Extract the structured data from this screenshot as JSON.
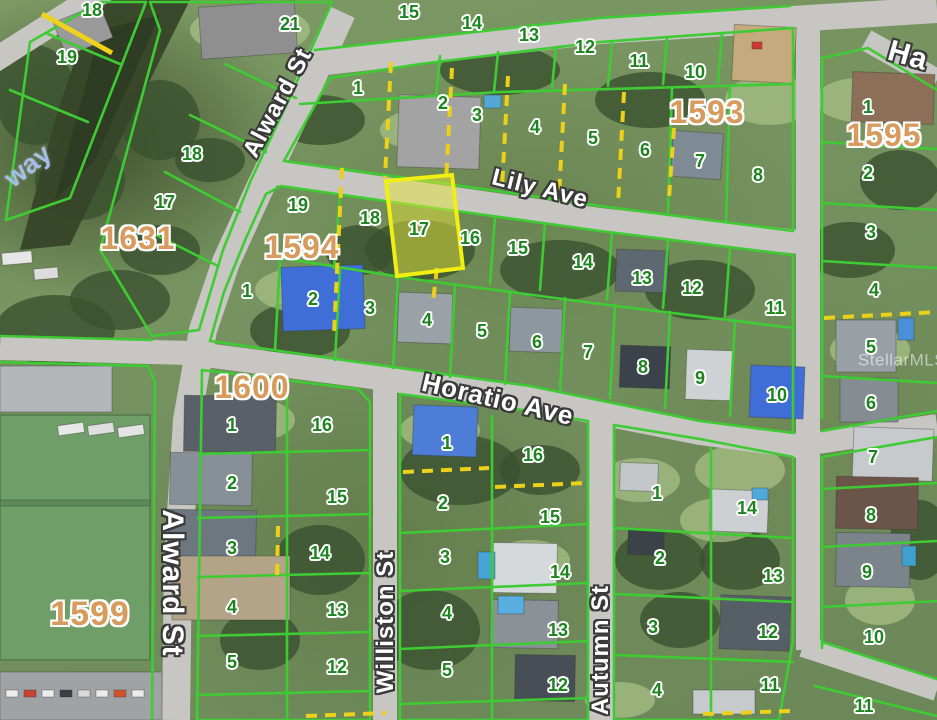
{
  "map": {
    "type": "parcel-plat-aerial-map",
    "colors": {
      "parcel_line": "#3ecb33",
      "lot_number": "#1d8420",
      "block_number": "#d89b5e",
      "street_text": "#ffffff",
      "combo_dash": "#ecd019",
      "highlight_fill": "#e6e63c",
      "highlight_border": "#f0ee12",
      "road": "#c7c6c2",
      "water_label": "#a5bdeb"
    }
  },
  "highlighted_parcel": {
    "lot": "17",
    "block": "1594"
  },
  "labels": {
    "streets": [
      {
        "text": "Alward St",
        "x": 278,
        "y": 103,
        "rot": -62,
        "size": 24
      },
      {
        "text": "Alward St",
        "x": 172,
        "y": 583,
        "rot": 90,
        "size": 30
      },
      {
        "text": "Lily Ave",
        "x": 540,
        "y": 189,
        "rot": 14,
        "size": 24
      },
      {
        "text": "Horatio Ave",
        "x": 498,
        "y": 399,
        "rot": 13,
        "size": 26
      },
      {
        "text": "Williston St",
        "x": 386,
        "y": 622,
        "rot": -90,
        "size": 24
      },
      {
        "text": "Autumn St",
        "x": 601,
        "y": 650,
        "rot": -90,
        "size": 24
      },
      {
        "text": "Ha",
        "x": 908,
        "y": 56,
        "rot": 16,
        "size": 30
      }
    ],
    "blocks": [
      {
        "text": "1631",
        "x": 138,
        "y": 238
      },
      {
        "text": "1593",
        "x": 707,
        "y": 112
      },
      {
        "text": "1595",
        "x": 884,
        "y": 135
      },
      {
        "text": "1594",
        "x": 302,
        "y": 247
      },
      {
        "text": "1600",
        "x": 252,
        "y": 387
      },
      {
        "text": "1599",
        "x": 90,
        "y": 614,
        "size": 34
      }
    ],
    "lots": [
      {
        "text": "18",
        "x": 92,
        "y": 10
      },
      {
        "text": "19",
        "x": 67,
        "y": 57
      },
      {
        "text": "21",
        "x": 290,
        "y": 24
      },
      {
        "text": "18",
        "x": 192,
        "y": 154
      },
      {
        "text": "17",
        "x": 165,
        "y": 202
      },
      {
        "text": "15",
        "x": 409,
        "y": 12
      },
      {
        "text": "14",
        "x": 472,
        "y": 23
      },
      {
        "text": "13",
        "x": 529,
        "y": 35
      },
      {
        "text": "12",
        "x": 585,
        "y": 47
      },
      {
        "text": "11",
        "x": 639,
        "y": 61
      },
      {
        "text": "10",
        "x": 695,
        "y": 72
      },
      {
        "text": "1",
        "x": 358,
        "y": 88
      },
      {
        "text": "2",
        "x": 443,
        "y": 103
      },
      {
        "text": "3",
        "x": 477,
        "y": 115
      },
      {
        "text": "4",
        "x": 535,
        "y": 127
      },
      {
        "text": "5",
        "x": 593,
        "y": 138
      },
      {
        "text": "6",
        "x": 645,
        "y": 150
      },
      {
        "text": "7",
        "x": 700,
        "y": 161
      },
      {
        "text": "8",
        "x": 758,
        "y": 175
      },
      {
        "text": "1",
        "x": 868,
        "y": 107
      },
      {
        "text": "2",
        "x": 868,
        "y": 173
      },
      {
        "text": "3",
        "x": 871,
        "y": 232
      },
      {
        "text": "4",
        "x": 874,
        "y": 290
      },
      {
        "text": "5",
        "x": 871,
        "y": 347
      },
      {
        "text": "6",
        "x": 871,
        "y": 403
      },
      {
        "text": "7",
        "x": 873,
        "y": 457
      },
      {
        "text": "8",
        "x": 871,
        "y": 515
      },
      {
        "text": "9",
        "x": 867,
        "y": 572
      },
      {
        "text": "10",
        "x": 874,
        "y": 637
      },
      {
        "text": "11",
        "x": 864,
        "y": 706
      },
      {
        "text": "19",
        "x": 298,
        "y": 205
      },
      {
        "text": "18",
        "x": 370,
        "y": 218
      },
      {
        "text": "17",
        "x": 419,
        "y": 229
      },
      {
        "text": "16",
        "x": 470,
        "y": 238
      },
      {
        "text": "15",
        "x": 518,
        "y": 248
      },
      {
        "text": "14",
        "x": 583,
        "y": 262
      },
      {
        "text": "13",
        "x": 642,
        "y": 278
      },
      {
        "text": "12",
        "x": 692,
        "y": 288
      },
      {
        "text": "11",
        "x": 775,
        "y": 308
      },
      {
        "text": "1",
        "x": 247,
        "y": 291
      },
      {
        "text": "2",
        "x": 313,
        "y": 299
      },
      {
        "text": "3",
        "x": 370,
        "y": 308
      },
      {
        "text": "4",
        "x": 427,
        "y": 320
      },
      {
        "text": "5",
        "x": 482,
        "y": 331
      },
      {
        "text": "6",
        "x": 537,
        "y": 342
      },
      {
        "text": "7",
        "x": 588,
        "y": 352
      },
      {
        "text": "8",
        "x": 643,
        "y": 367
      },
      {
        "text": "9",
        "x": 700,
        "y": 378
      },
      {
        "text": "10",
        "x": 777,
        "y": 395
      },
      {
        "text": "1",
        "x": 232,
        "y": 425
      },
      {
        "text": "2",
        "x": 232,
        "y": 483
      },
      {
        "text": "3",
        "x": 232,
        "y": 548
      },
      {
        "text": "4",
        "x": 232,
        "y": 607
      },
      {
        "text": "5",
        "x": 232,
        "y": 662
      },
      {
        "text": "16",
        "x": 322,
        "y": 425
      },
      {
        "text": "15",
        "x": 337,
        "y": 497
      },
      {
        "text": "14",
        "x": 320,
        "y": 553
      },
      {
        "text": "13",
        "x": 337,
        "y": 610
      },
      {
        "text": "12",
        "x": 337,
        "y": 667
      },
      {
        "text": "1",
        "x": 447,
        "y": 443
      },
      {
        "text": "2",
        "x": 443,
        "y": 503
      },
      {
        "text": "3",
        "x": 445,
        "y": 557
      },
      {
        "text": "4",
        "x": 447,
        "y": 613
      },
      {
        "text": "5",
        "x": 447,
        "y": 670
      },
      {
        "text": "16",
        "x": 533,
        "y": 455
      },
      {
        "text": "15",
        "x": 550,
        "y": 517
      },
      {
        "text": "14",
        "x": 560,
        "y": 572
      },
      {
        "text": "13",
        "x": 558,
        "y": 630
      },
      {
        "text": "12",
        "x": 558,
        "y": 685
      },
      {
        "text": "1",
        "x": 657,
        "y": 493
      },
      {
        "text": "2",
        "x": 660,
        "y": 558
      },
      {
        "text": "3",
        "x": 653,
        "y": 627
      },
      {
        "text": "4",
        "x": 657,
        "y": 690
      },
      {
        "text": "14",
        "x": 747,
        "y": 508
      },
      {
        "text": "13",
        "x": 773,
        "y": 576
      },
      {
        "text": "12",
        "x": 768,
        "y": 632
      },
      {
        "text": "11",
        "x": 770,
        "y": 685
      }
    ],
    "water": [
      {
        "text": "way",
        "x": 28,
        "y": 166,
        "rot": -38
      }
    ],
    "watermark": [
      {
        "text": "StellarMLS",
        "x": 902,
        "y": 360
      }
    ]
  }
}
